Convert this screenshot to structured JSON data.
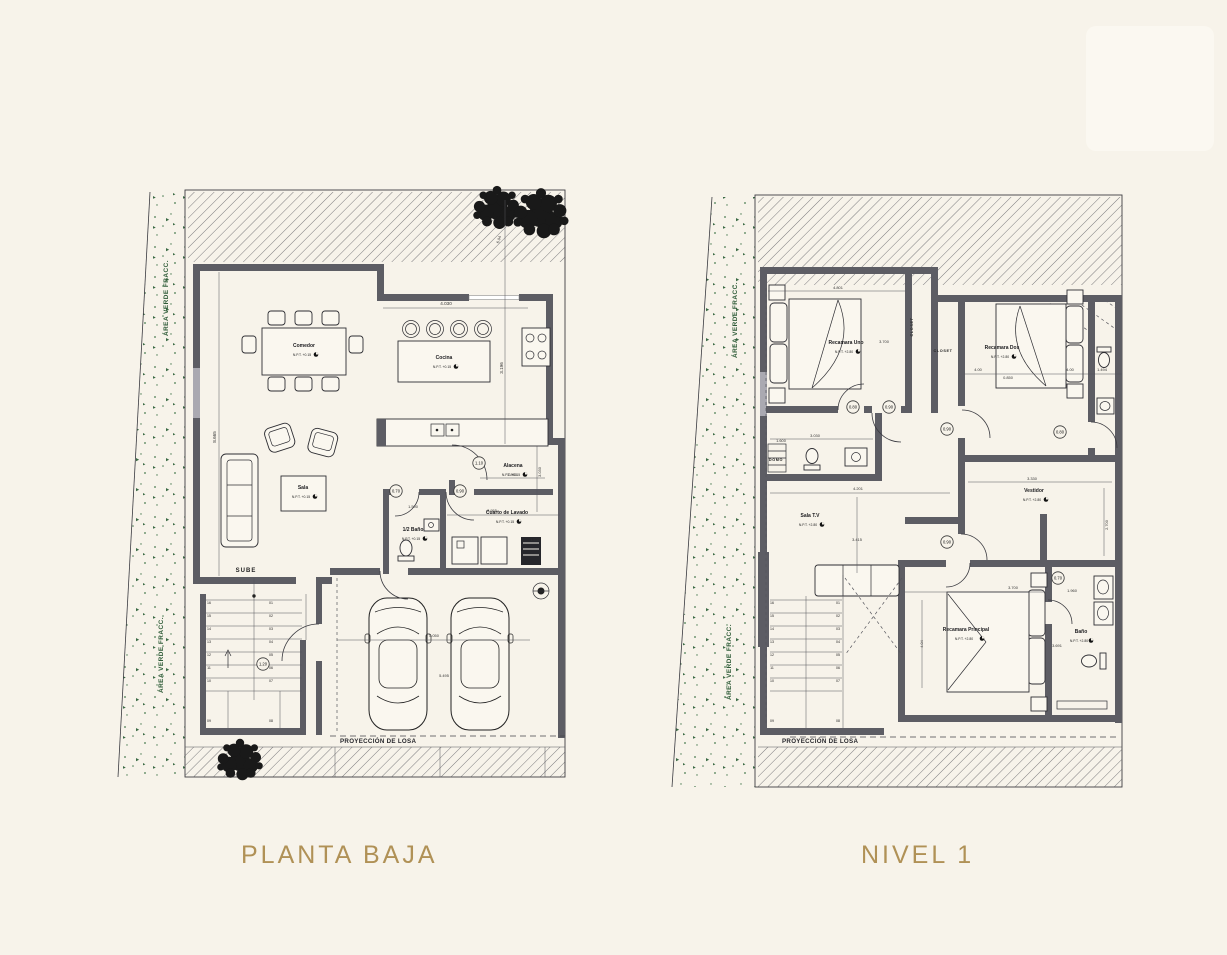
{
  "page": {
    "background": "#f7f3ea",
    "accent": "#b09156",
    "wall_color": "#5d5d64",
    "green": "#2f5c38"
  },
  "titles": {
    "left": "PLANTA BAJA",
    "right": "NIVEL 1"
  },
  "common": {
    "site_label": "ÁREA VERDE FRACC.",
    "slab_label": "PROYECCIÓN DE LOSA"
  },
  "ground": {
    "level_note": "N.P.T. +0.15",
    "rooms": {
      "dining": "Comedor",
      "kitchen": "Cocina",
      "living": "Sala",
      "half_bath": "1/2 Baño",
      "pantry": "Alacena",
      "laundry": "Cuarto de Lavado",
      "stairs": "SUBE"
    },
    "dims": {
      "top_width": "4.030",
      "kitchen_height": "3.196",
      "left_height": "8.665",
      "terrace": "6.04",
      "pantry_width": "1.893",
      "pantry_height": "3.030",
      "laundry_width": "2.955",
      "laundry_height": "1.530",
      "hall": "1.500",
      "garage_width": "5.050",
      "garage_depth": "5.495"
    },
    "doors": {
      "half_bath": "0.70",
      "hall": "0.90",
      "pantry": "1.10",
      "entry": "1.20"
    },
    "stairs": {
      "left": [
        "16",
        "15",
        "14",
        "13",
        "12",
        "11",
        "10"
      ],
      "right": [
        "01",
        "02",
        "03",
        "04",
        "05",
        "06",
        "07"
      ],
      "bottom": [
        "09",
        "08"
      ]
    }
  },
  "upper": {
    "level_note": "N.P.T. +2.80",
    "rooms": {
      "bedroom_one": "Recamara Uno",
      "bedroom_two": "Recamara Dos",
      "closet_a": "CLOSET",
      "closet_b": "CLOSET",
      "tv_room": "Sala T.V",
      "dressing": "Vestidor",
      "master": "Recamara Principal",
      "bath": "Baño",
      "skylight": "DOMO"
    },
    "dims": {
      "bedroom_one_width": "4.801",
      "bedroom_one_depth": "3.700",
      "bedroom_two_left": "4.00",
      "bed_width": "0.850",
      "bedroom_two_right": "4.00",
      "bath_top": "1.494",
      "skylight_bath_depth": "1.600",
      "skylight_bath_width": "3.030",
      "tv_width": "4.201",
      "tv_depth": "3.415",
      "dressing_width": "3.330",
      "dressing_depth": "2.700",
      "master_width": "3.700",
      "master_depth": "4.04",
      "bath_width": "3.691",
      "bath_depth": "1.960"
    },
    "doors": {
      "bedroom_one": "0.80",
      "hall_bath": "0.90",
      "bedroom_two": "0.90",
      "bath_two": "0.80",
      "dressing": "0.90",
      "master_bath": "0.70"
    },
    "stairs": {
      "left": [
        "16",
        "15",
        "14",
        "13",
        "12",
        "11",
        "10"
      ],
      "right": [
        "01",
        "02",
        "03",
        "04",
        "05",
        "06",
        "07"
      ],
      "bottom": [
        "09",
        "08"
      ]
    }
  }
}
